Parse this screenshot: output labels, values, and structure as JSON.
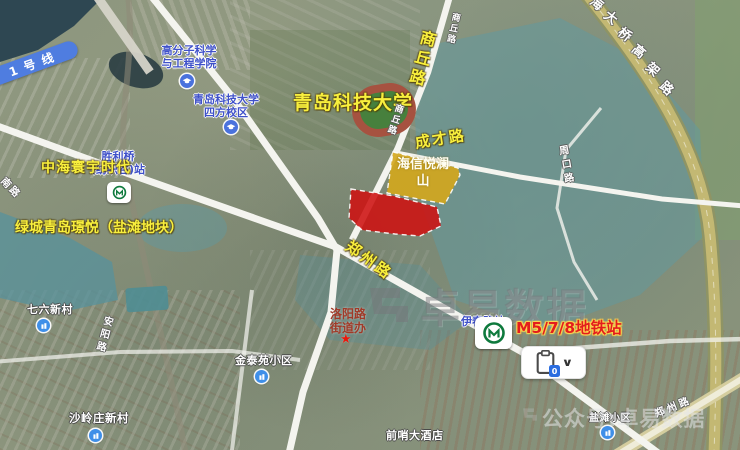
{
  "colors": {
    "annotation_yellow": "#f8ef3d",
    "zone_red": "#ce1111",
    "zone_yellow": "#d4a71c",
    "poi_blue_text": "#3f51c9",
    "metro_green": "#0e7a3d",
    "poi_marker_blue": "#3f8fe8",
    "station_red_text": "#e31d1d",
    "line_badge_blue": "#4f7de0",
    "office_red_text": "#a03a28"
  },
  "transit": {
    "line1_badge": "1号线",
    "shengliqiao_station_line1": "胜利桥",
    "shengliqiao_station_line2": "(纺织谷)站",
    "m578_station_label": "M5/7/8地铁站",
    "yichun_station_label": "伊春路站"
  },
  "roads": {
    "shangqiu_annotation": "商丘路",
    "shangqiu_map_label_top": "商丘路",
    "shangqiu_map_label_mid": "商丘路",
    "chengcai": "成才路",
    "zhengzhou_annotation": "郑州路",
    "zhengzhou_map_label": "郑州路",
    "zhoukou": "周口路",
    "anyang": "安阳路",
    "nan_lu_partial": "南路",
    "highway_chars": [
      "海",
      "大",
      "桥",
      "高",
      "架",
      "路"
    ]
  },
  "pois": {
    "polymer_college_line1": "高分子科学",
    "polymer_college_line2": "与工程学院",
    "qust_campus_line1": "青岛科技大学",
    "qust_campus_line2": "四方校区",
    "qust_annotation": "青岛科技大学",
    "zhonghai_annotation": "中海寰宇时代",
    "lvcheng_annotation": "绿城青岛璟悦（盐滩地块）",
    "hisense_zone_line1": "海信悦澜",
    "hisense_zone_line2": "山",
    "luoyang_office_line1": "洛阳路",
    "luoyang_office_line2": "街道办",
    "qiliu_village": "七六新村",
    "jintai_community": "金泰苑小区",
    "shaling_village": "沙岭庄新村",
    "qianshao_hotel": "前哨大酒店",
    "yantan_community": "盐滩小区"
  },
  "watermarks": {
    "center": "卓易数据",
    "bottom": "公众号:卓易数据"
  },
  "controls": {
    "clipboard_badge": "0",
    "chevron": "∨"
  },
  "icons": {
    "star": "★"
  }
}
